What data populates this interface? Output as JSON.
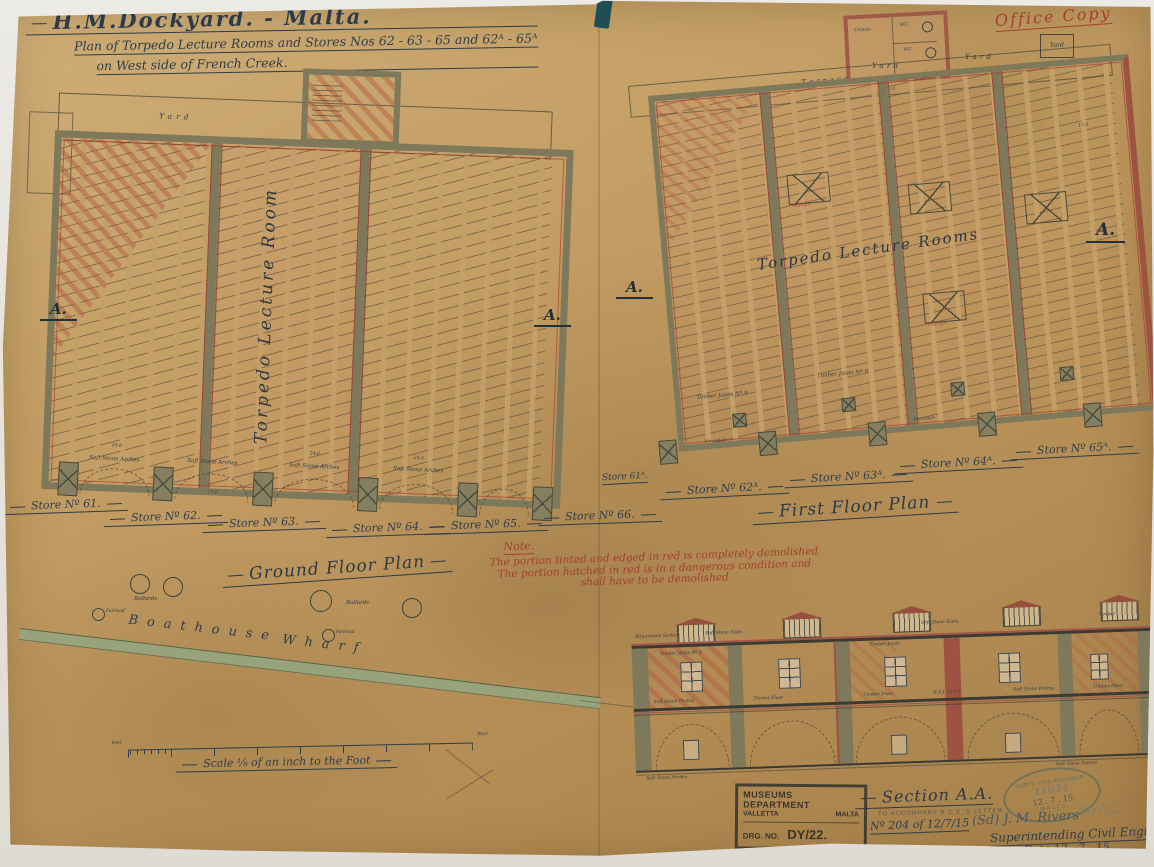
{
  "title": {
    "line1": "H.M.Dockyard. - Malta.",
    "line2": "Plan of Torpedo Lecture Rooms and Stores Nos 62 - 63 - 65 and 62ᴬ - 65ᴬ",
    "line3": "on West side of French Creek.",
    "office_copy": "Office Copy"
  },
  "ground_floor": {
    "caption": "Ground Floor Plan",
    "room_label": "Torpedo Lecture Room",
    "yard": "Yard",
    "marker_left": "A.",
    "marker_right": "A.",
    "stores": [
      "Store Nº 61.",
      "Store Nº 62.",
      "Store Nº 63.",
      "Store Nº 64.",
      "Store Nº 65.",
      "Store Nº 66."
    ],
    "arch_label": "Soft Stone Arches",
    "dims": [
      "24.6",
      "24.6",
      "24.6",
      "17.6"
    ],
    "bollards": "Bollards",
    "fairlead": "Fairlead",
    "wharf_word1": "Boathouse",
    "wharf_word2": "Wharf",
    "feet_left": "Feet",
    "feet_right": "Feet",
    "scale_caption": "Scale ⅛ of an inch to the Foot"
  },
  "first_floor": {
    "caption": "First Floor Plan",
    "rooms_label": "Torpedo Lecture Rooms",
    "terrace": "Terrace",
    "yard": "Yard",
    "wc": "W.C.",
    "urinals": "Urinals",
    "verandah": "Verandah",
    "skylight": "Skylight",
    "timber": "Timber Joists Nº 9",
    "marker_left": "A.",
    "marker_right": "A.",
    "stores": [
      "Store 61ᴬ.",
      "Store Nº 62ᴬ.",
      "Store Nº 63ᴬ.",
      "Store Nº 64ᴬ.",
      "Store Nº 65ᴬ."
    ],
    "dims": [
      "22.9",
      "17.3"
    ]
  },
  "note": {
    "heading": "Note.",
    "line1": "The portion tinted and edged in red is completely demolished",
    "line2": "The portion hatched in red is in a dangerous  condition  and",
    "line3": "shall have to be demolished"
  },
  "section": {
    "caption": "Section A.A.",
    "top_labels": [
      "Bituminous Surface",
      "Soft Stone Slabs",
      "Soft Stone Slabs",
      "Timber"
    ],
    "mid_labels": [
      "Timber Joists Nº 8",
      "Timber Joists",
      "R.S.J. 15 x 5"
    ],
    "floor_labels": [
      "Soft Stone Paving",
      "Timber Floor",
      "Timber Floor",
      "Soft Stone Paving",
      "Timber Floor"
    ],
    "bottom_labels": [
      "Soft Stone Arches",
      "Soft Stone Arches"
    ]
  },
  "stamps": {
    "dept_name": "MUSEUMS DEPARTMENT",
    "dept_city": "VALLETTA",
    "dept_country": "MALTA",
    "drg_label": "DRG. NO.",
    "drg_value": "DY/22.",
    "oval_top": "SUPTG CIVIL ENGINEER",
    "oval_number": "11024",
    "oval_date": "12 . 7 . 15",
    "oval_bottom": "MALTA",
    "letter_note": "TO ACCOMPANY R.C.E.'S LETTER",
    "letter_ref": "Nº 204 of 12/7/15",
    "signature": "(Sd) J. M. Rivers",
    "pencil_ref": "DY/22",
    "engineer_title": "Superintending Civil Engineer",
    "date": "Date 12 . 7 . 15"
  }
}
